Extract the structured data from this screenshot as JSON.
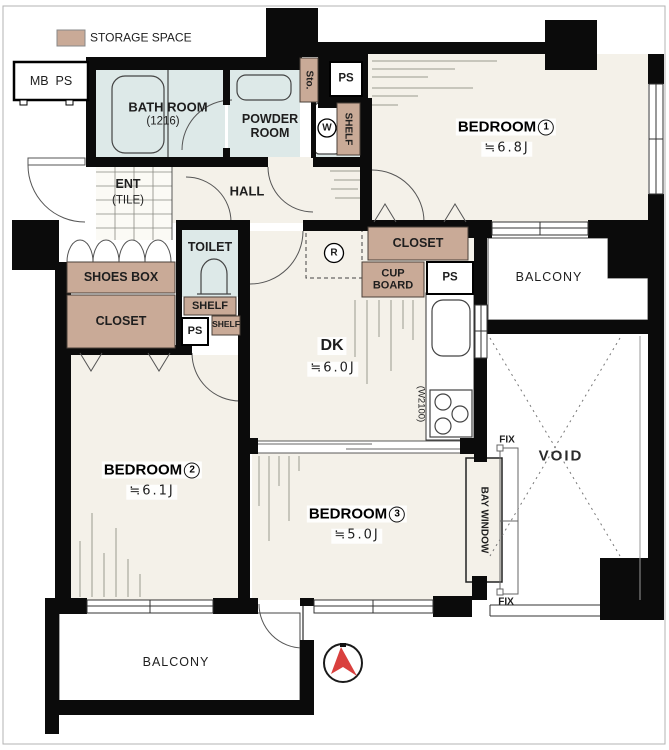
{
  "legend": {
    "storage_space": "STORAGE SPACE"
  },
  "outside": {
    "mb_ps": "MB  PS"
  },
  "rooms": {
    "bedroom1": {
      "name": "BEDROOM",
      "num": "1",
      "size": "≒6.8J"
    },
    "bedroom2": {
      "name": "BEDROOM",
      "num": "2",
      "size": "≒6.1J"
    },
    "bedroom3": {
      "name": "BEDROOM",
      "num": "3",
      "size": "≒5.0J"
    },
    "dk": {
      "name": "DK",
      "size": "≒6.0J"
    },
    "bath": {
      "name": "BATH ROOM",
      "size": "(1216)"
    },
    "powder": {
      "name": "POWDER\nROOM"
    },
    "toilet": {
      "name": "TOILET"
    },
    "hall": {
      "name": "HALL"
    },
    "ent": {
      "name": "ENT",
      "floor": "(TILE)"
    },
    "void": {
      "name": "VOID"
    },
    "balcony": {
      "name": "BALCONY"
    }
  },
  "storage": {
    "shoes_box": "SHOES BOX",
    "closet": "CLOSET",
    "cup_board": "CUP\nBOARD",
    "shelf": "SHELF",
    "sto": "Sto."
  },
  "fixtures": {
    "washer": "W",
    "fridge": "R",
    "kitchen_width": "(W2100)"
  },
  "misc": {
    "ps": "PS",
    "fix": "FIX",
    "bay_window": "BAY WINDOW"
  },
  "colors": {
    "storage": "#c9aa97",
    "wet_area": "#dde9e8",
    "floor": "#f4f1e9",
    "wall": "#0b0b0b",
    "compass_red": "#d9403e"
  }
}
